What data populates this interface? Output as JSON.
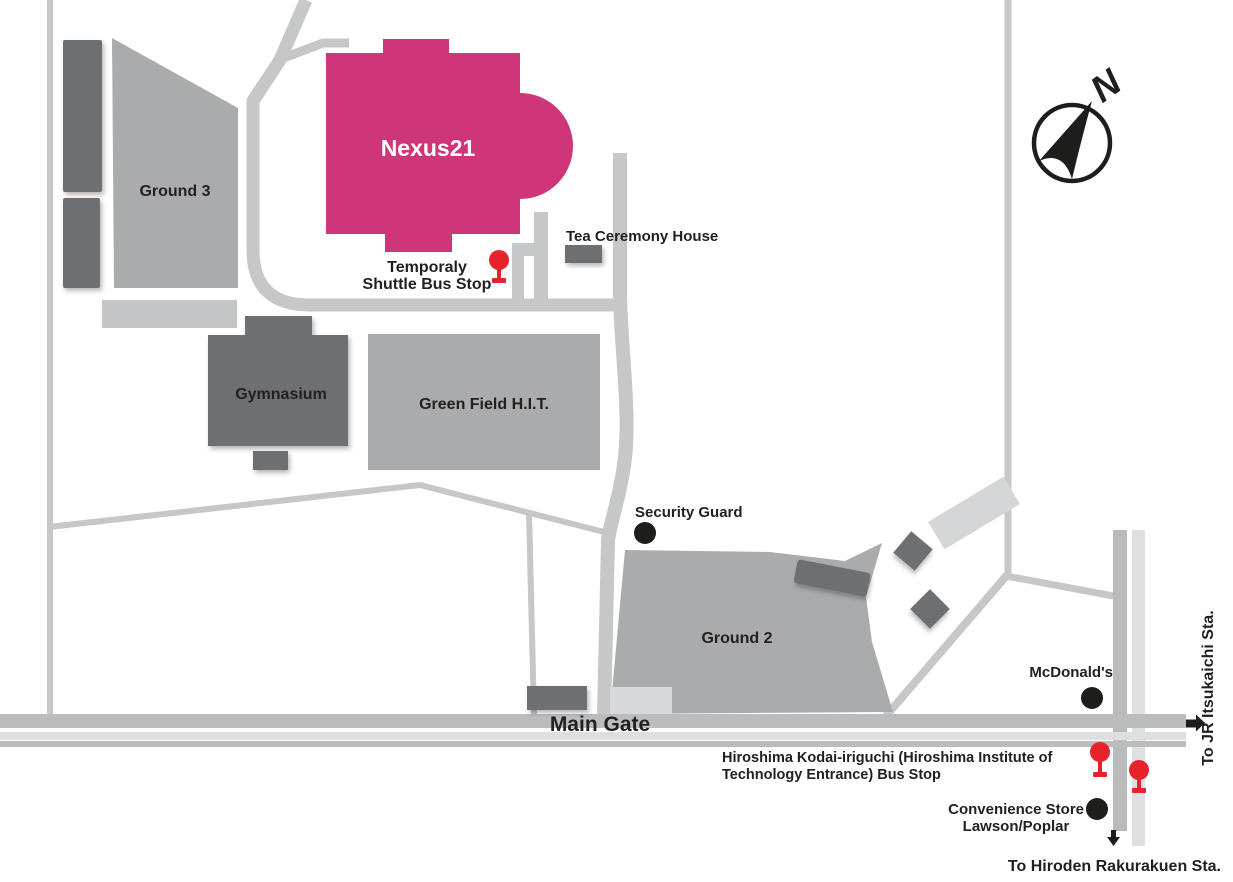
{
  "labels": {
    "ground3": "Ground 3",
    "nexus21": "Nexus21",
    "tea_ceremony_house": "Tea Ceremony House",
    "shuttle_line1": "Temporaly",
    "shuttle_line2": "Shuttle Bus Stop",
    "gymnasium": "Gymnasium",
    "green_field": "Green Field H.I.T.",
    "security_guard": "Security Guard",
    "ground2": "Ground 2",
    "mcdonalds": "McDonald's",
    "main_gate": "Main Gate",
    "bus_stop_line1": "Hiroshima Kodai-iriguchi (Hiroshima Institute of",
    "bus_stop_line2": "Technology Entrance) Bus Stop",
    "convenience_line1": "Convenience Store",
    "convenience_line2": "Lawson/Poplar",
    "to_hiroden": "To Hiroden Rakurakuen Sta.",
    "to_jr": "To JR Itsukaichi Sta.",
    "compass_north": "N"
  },
  "markers": [
    {
      "name": "temporaly-shuttle-bus-stop-pin",
      "type": "bus-stop-pin"
    },
    {
      "name": "kodai-iriguchi-bus-stop-pin-west",
      "type": "bus-stop-pin"
    },
    {
      "name": "kodai-iriguchi-bus-stop-pin-east",
      "type": "bus-stop-pin"
    },
    {
      "name": "security-guard-dot",
      "type": "poi-dot"
    },
    {
      "name": "mcdonalds-dot",
      "type": "poi-dot"
    },
    {
      "name": "convenience-store-dot",
      "type": "poi-dot"
    },
    {
      "name": "main-gate-right-arrow",
      "type": "direction-arrow"
    },
    {
      "name": "rakurakuen-down-arrow",
      "type": "direction-arrow"
    },
    {
      "name": "compass-rose",
      "type": "compass"
    }
  ],
  "colors": {
    "building_pink": "#cf3679",
    "building_dark_gray": "#6d6f72",
    "building_gray": "#a9abad",
    "building_light_gray": "#c5c6c8",
    "road_gray": "#c6c7c9",
    "road_light": "#dedfe0",
    "road_medium": "#b9babc",
    "main_gate_band": "#bbbcbe",
    "ground2_pad": "#d8d9da",
    "marker_red": "#e8222d",
    "marker_black": "#1d1d1b",
    "text": "#231f20"
  }
}
